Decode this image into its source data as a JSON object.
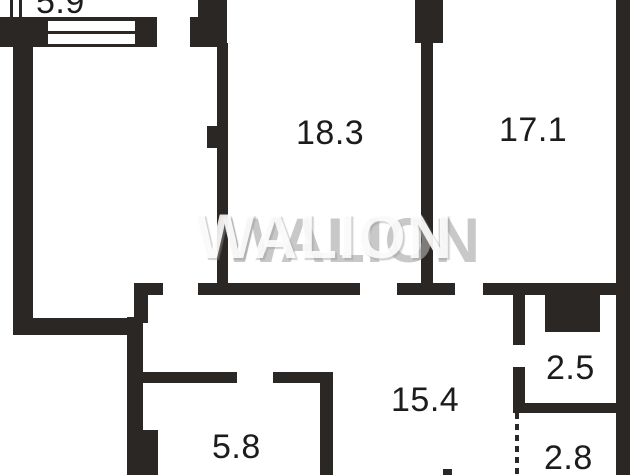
{
  "plan": {
    "watermark": "WALION",
    "rooms": [
      {
        "name": "balcony-top",
        "area": "5.9"
      },
      {
        "name": "room-top-center",
        "area": "18.3"
      },
      {
        "name": "room-top-right",
        "area": "17.1"
      },
      {
        "name": "hallway-center",
        "area": "15.4"
      },
      {
        "name": "room-bottom-left",
        "area": "5.8"
      },
      {
        "name": "wc-right",
        "area": "2.5"
      },
      {
        "name": "bath-bottom-right",
        "area": "2.8"
      }
    ],
    "colors": {
      "wall": "#2b2724",
      "label": "#1c1c1c",
      "watermark_front": "#ffffff",
      "watermark_back": "#aaaaaa"
    }
  }
}
